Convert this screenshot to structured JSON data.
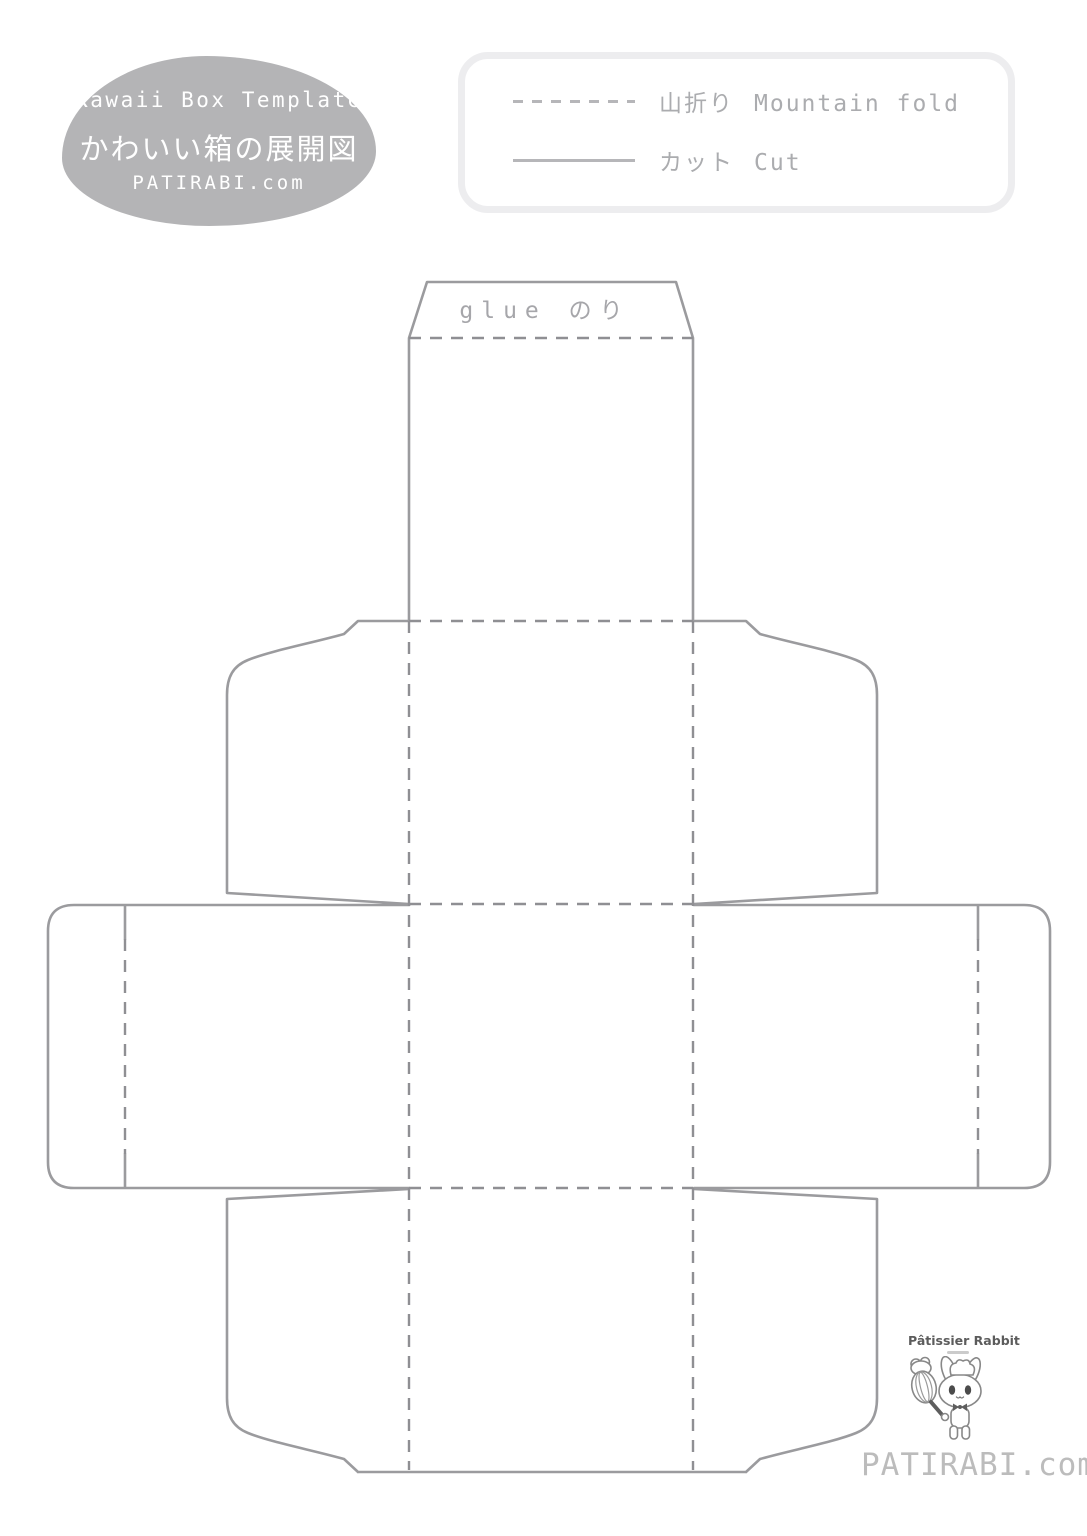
{
  "title_blob": {
    "line1": "Kawaii Box Template",
    "line2": "かわいい箱の展開図",
    "line3": "PATIRABI.com",
    "fill": "#b4b4b6",
    "text_color": "#ffffff"
  },
  "legend": {
    "items": [
      {
        "line_style": "dashed",
        "label_ja": "山折り",
        "label_en": "Mountain fold"
      },
      {
        "line_style": "solid",
        "label_ja": "カット",
        "label_en": "Cut"
      }
    ],
    "border_color": "#ededef",
    "line_color": "#b6b6b9",
    "text_color": "#abacaf"
  },
  "template": {
    "glue_label": "glue のり",
    "cut_color": "#9b9b9e",
    "fold_color": "#8f8f93"
  },
  "footer": {
    "mascot_title": "Pâtissier Rabbit",
    "site": "PATIRABI.com",
    "site_color": "#bcbcbc"
  }
}
